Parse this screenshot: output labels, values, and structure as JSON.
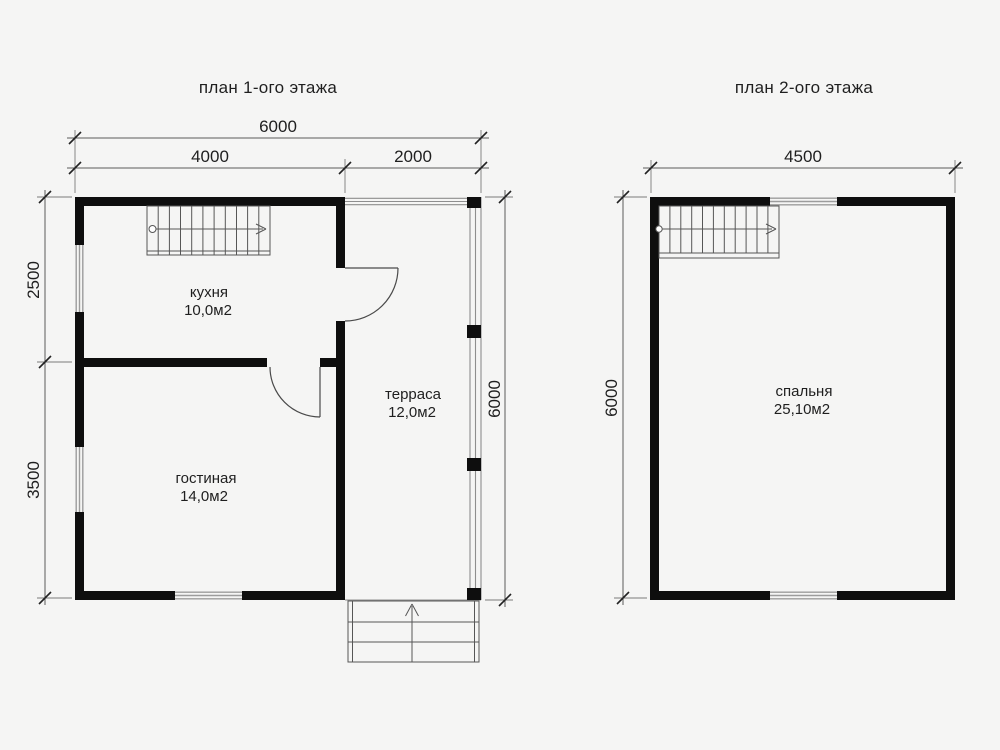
{
  "page": {
    "background": "#f5f5f4",
    "wall_color": "#0e0e0e",
    "line_color": "#565656"
  },
  "plan1": {
    "title": "план 1-ого этажа",
    "dims": {
      "total_width": "6000",
      "house_width": "4000",
      "terrace_width": "2000",
      "kitchen_depth": "2500",
      "living_depth": "3500",
      "total_depth": "6000"
    },
    "rooms": {
      "kitchen": {
        "name": "кухня",
        "area": "10,0м2"
      },
      "living": {
        "name": "гостиная",
        "area": "14,0м2"
      },
      "terrace": {
        "name": "терраса",
        "area": "12,0м2"
      }
    }
  },
  "plan2": {
    "title": "план 2-ого этажа",
    "dims": {
      "total_width": "4500",
      "total_depth": "6000"
    },
    "rooms": {
      "bedroom": {
        "name": "спальня",
        "area": "25,10м2"
      }
    }
  }
}
